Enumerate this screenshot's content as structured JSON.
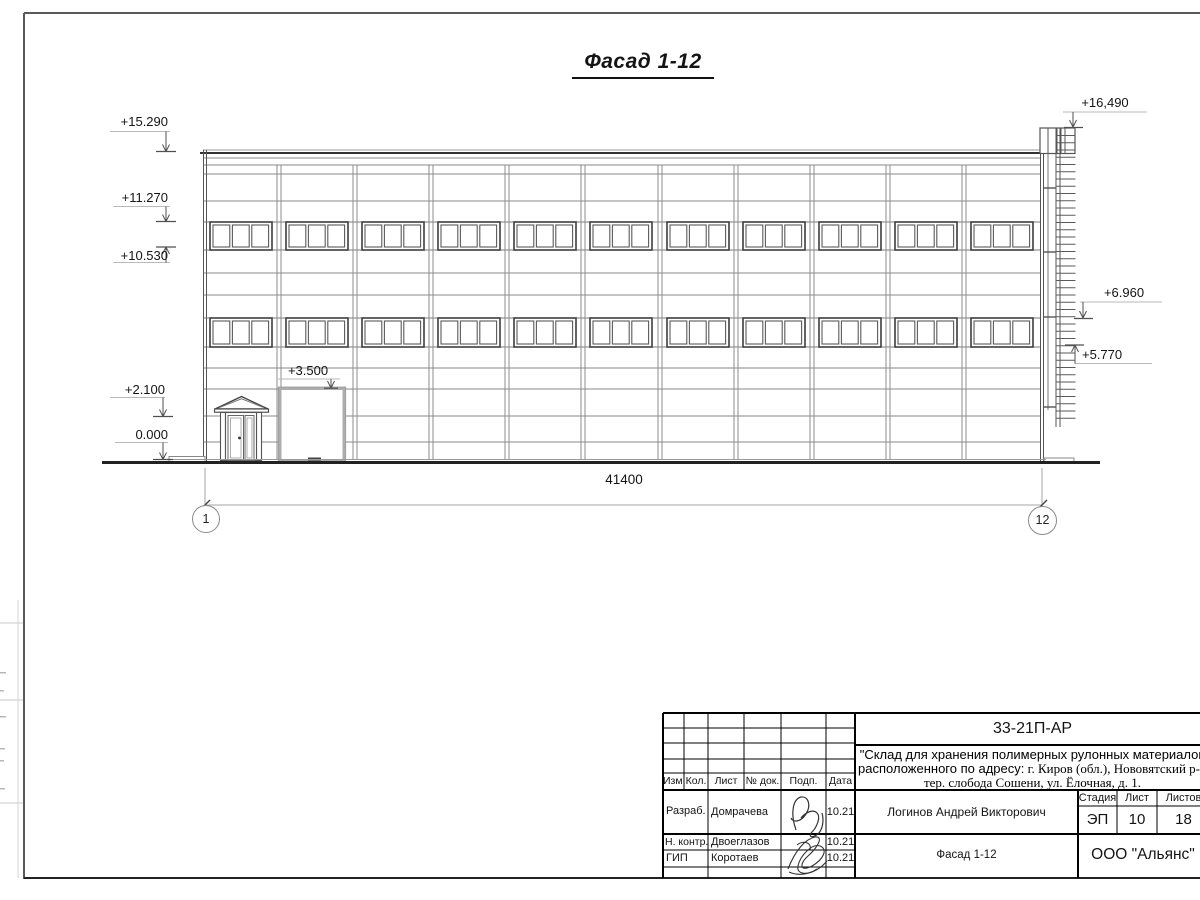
{
  "sheet": {
    "title": "Фасад 1-12"
  },
  "dimension": {
    "total": "41400",
    "axis_left": "1",
    "axis_right": "12"
  },
  "elevations": {
    "left": [
      {
        "label": "+15.290"
      },
      {
        "label": "+11.270"
      },
      {
        "label": "+10.530"
      },
      {
        "label": "+2.100"
      },
      {
        "label": "0.000"
      }
    ],
    "right": [
      {
        "label": "+16,490"
      },
      {
        "label": "+6.960"
      },
      {
        "label": "+5.770"
      }
    ],
    "gate": {
      "label": "+3.500"
    }
  },
  "title_block": {
    "doc_code": "33-21П-АР",
    "project_line1": "\"Склад для хранения полимерных рулонных материалов",
    "project_line2_plain": "расположенного по адресу:",
    "project_line2_serif": " г. Киров (обл.), Нововятский р-н",
    "project_line3": "тер. слобода Сошени, ул. Ёлочная, д. 1.",
    "cols": {
      "izm": "Изм.",
      "kol": "Кол.",
      "list": "Лист",
      "doc": "№ док.",
      "podp": "Подп.",
      "data": "Дата"
    },
    "roles": {
      "developer": "Разраб.",
      "control": "Н. контр.",
      "gip": "ГИП"
    },
    "names": {
      "developer": "Домрачева",
      "control": "Двоеглазов",
      "gip": "Коротаев"
    },
    "dates": {
      "developer": "10.21",
      "control": "10.21",
      "gip": "10.21"
    },
    "chief_name": "Логинов Андрей Викторович",
    "stage_label": "Стадия",
    "sheet_label": "Лист",
    "sheets_label": "Листов",
    "stage": "ЭП",
    "sheet_number": "10",
    "sheets_total": "18",
    "drawing_title": "Фасад 1-12",
    "company": "ООО \"Альянс\""
  }
}
